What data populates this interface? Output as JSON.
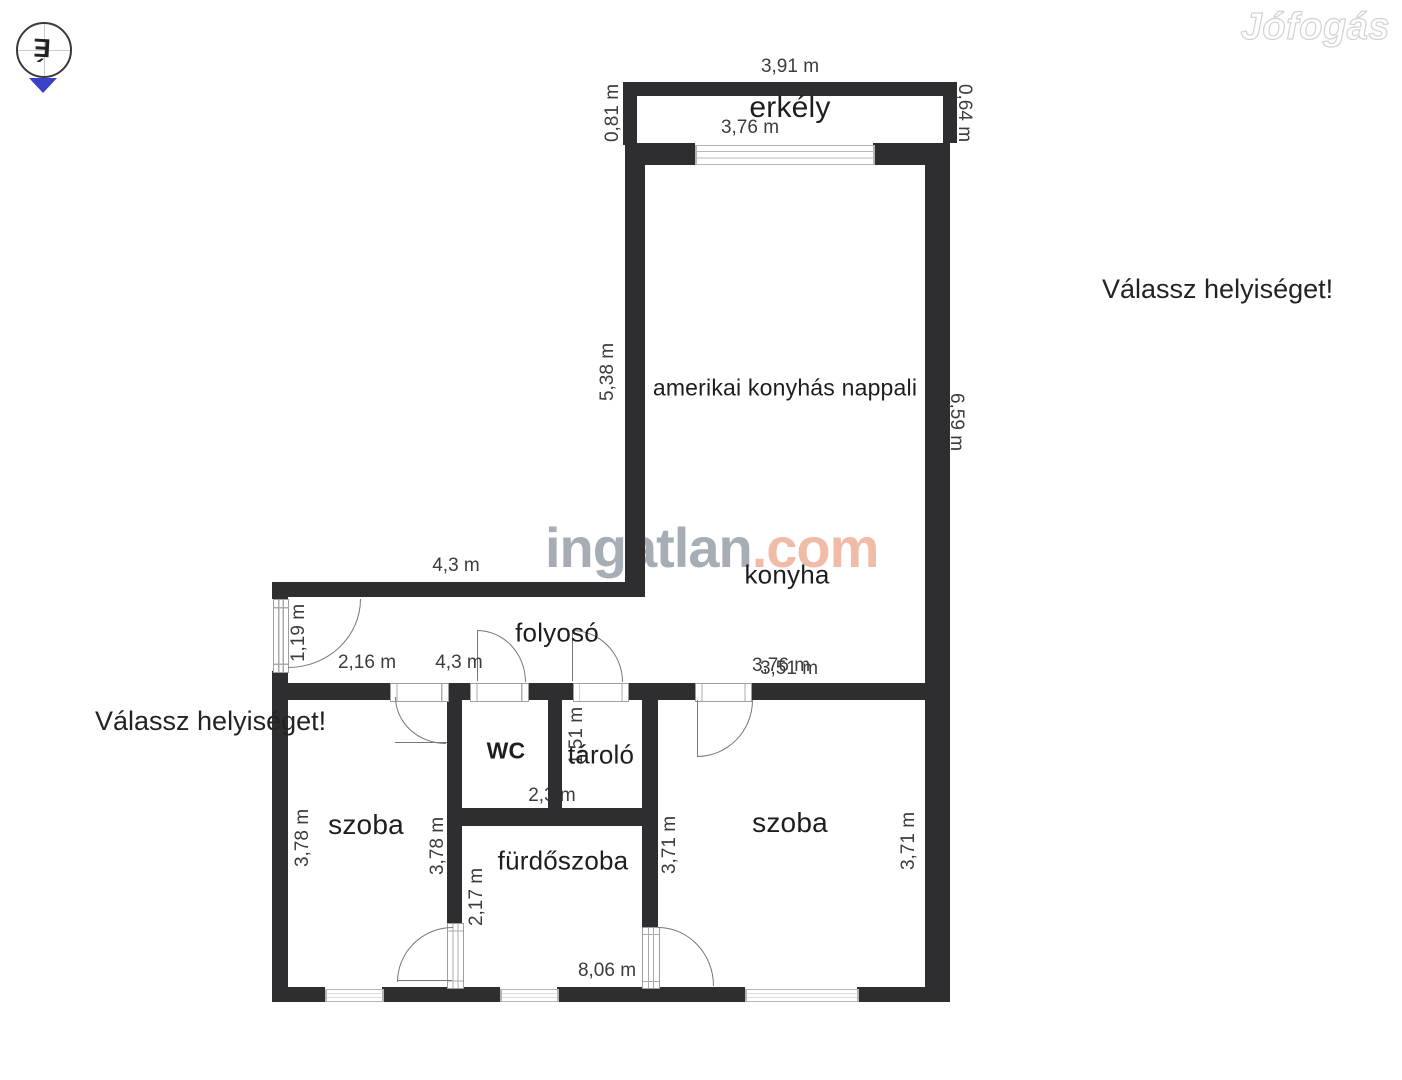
{
  "watermarks": {
    "jofogas": "Jófogás",
    "ingatlan_gray": "ingatlan",
    "ingatlan_accent": ".com"
  },
  "overlay": {
    "prompt_left": "Válassz helyiséget!",
    "prompt_right": "Válassz helyiséget!"
  },
  "compass": {
    "letter": "É"
  },
  "colors": {
    "wall": "#2e2e30",
    "compass_triangle": "#3a41c6",
    "watermark_gray": "#a6adb5",
    "watermark_salmon": "#f0bca7"
  },
  "rooms": {
    "balcony": "erkély",
    "living": "amerikai konyhás nappali",
    "kitchen": "konyha",
    "hallway": "folyosó",
    "wc": "WC",
    "storage": "tároló",
    "room_left": "szoba",
    "bathroom": "fürdőszoba",
    "room_right": "szoba"
  },
  "dims": {
    "balcony_top": "3,91 m",
    "balcony_inner": "3,76 m",
    "balcony_left": "0,81 m",
    "balcony_right": "0,64 m",
    "living_left": "5,38 m",
    "living_right": "6,59 m",
    "hall_top": "4,3 m",
    "hall_inner": "4,3 m",
    "entry_door": "1,19 m",
    "hall_left": "2,16 m",
    "kitchen_width_a": "3,76 m",
    "kitchen_width_b": "3,51 m",
    "storage_height": "1,51 m",
    "wc_width": "2,3 m",
    "room_left_a": "3,78 m",
    "room_left_b": "3,78 m",
    "bathroom_height": "2,17 m",
    "room_right_a": "3,71 m",
    "room_right_b": "3,71 m",
    "bottom_total": "8,06 m"
  }
}
